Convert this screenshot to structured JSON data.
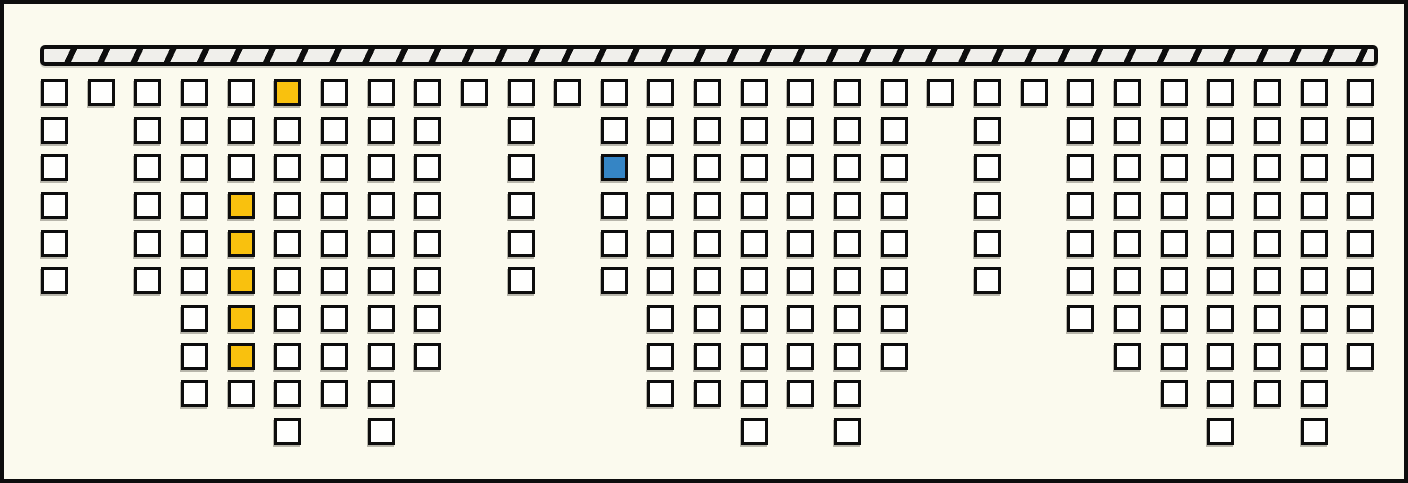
{
  "diagram": {
    "canvas": {
      "width_px": 1408,
      "height_px": 483,
      "background_color": "#fbfaee",
      "border_color": "#0d0d0d"
    },
    "ceiling_bar": {
      "x": 36,
      "y": 41,
      "width": 1338,
      "height": 21,
      "fill_color": "#f0efeb",
      "stripe_color": "#0d0d0d",
      "stripe_light_width_px": 24,
      "stripe_dark_width_px": 6,
      "stripe_angle_deg": 115
    },
    "grid": {
      "origin_x": 37,
      "origin_y": 75,
      "col_pitch": 46.65,
      "row_pitch": 37.66,
      "cell_size": 27,
      "default_fill": "#fffffe",
      "cell_border_color": "#0d0d0d",
      "highlight_colors": {
        "yellow": "#f9c10e",
        "blue": "#3585c5"
      },
      "columns": [
        {
          "index": 1,
          "height": 6
        },
        {
          "index": 2,
          "height": 1
        },
        {
          "index": 3,
          "height": 6
        },
        {
          "index": 4,
          "height": 9
        },
        {
          "index": 5,
          "height": 9
        },
        {
          "index": 6,
          "height": 10
        },
        {
          "index": 7,
          "height": 9
        },
        {
          "index": 8,
          "height": 10
        },
        {
          "index": 9,
          "height": 8
        },
        {
          "index": 10,
          "height": 1
        },
        {
          "index": 11,
          "height": 6
        },
        {
          "index": 12,
          "height": 1
        },
        {
          "index": 13,
          "height": 6
        },
        {
          "index": 14,
          "height": 9
        },
        {
          "index": 15,
          "height": 9
        },
        {
          "index": 16,
          "height": 10
        },
        {
          "index": 17,
          "height": 9
        },
        {
          "index": 18,
          "height": 10
        },
        {
          "index": 19,
          "height": 8
        },
        {
          "index": 20,
          "height": 1
        },
        {
          "index": 21,
          "height": 6
        },
        {
          "index": 22,
          "height": 1
        },
        {
          "index": 23,
          "height": 7
        },
        {
          "index": 24,
          "height": 8
        },
        {
          "index": 25,
          "height": 9
        },
        {
          "index": 26,
          "height": 10
        },
        {
          "index": 27,
          "height": 9
        },
        {
          "index": 28,
          "height": 10
        },
        {
          "index": 29,
          "height": 8
        }
      ],
      "highlights": [
        {
          "col": 6,
          "row": 1,
          "color": "yellow"
        },
        {
          "col": 5,
          "row": 4,
          "color": "yellow"
        },
        {
          "col": 5,
          "row": 5,
          "color": "yellow"
        },
        {
          "col": 5,
          "row": 6,
          "color": "yellow"
        },
        {
          "col": 5,
          "row": 7,
          "color": "yellow"
        },
        {
          "col": 5,
          "row": 8,
          "color": "yellow"
        },
        {
          "col": 13,
          "row": 3,
          "color": "blue"
        }
      ]
    }
  }
}
